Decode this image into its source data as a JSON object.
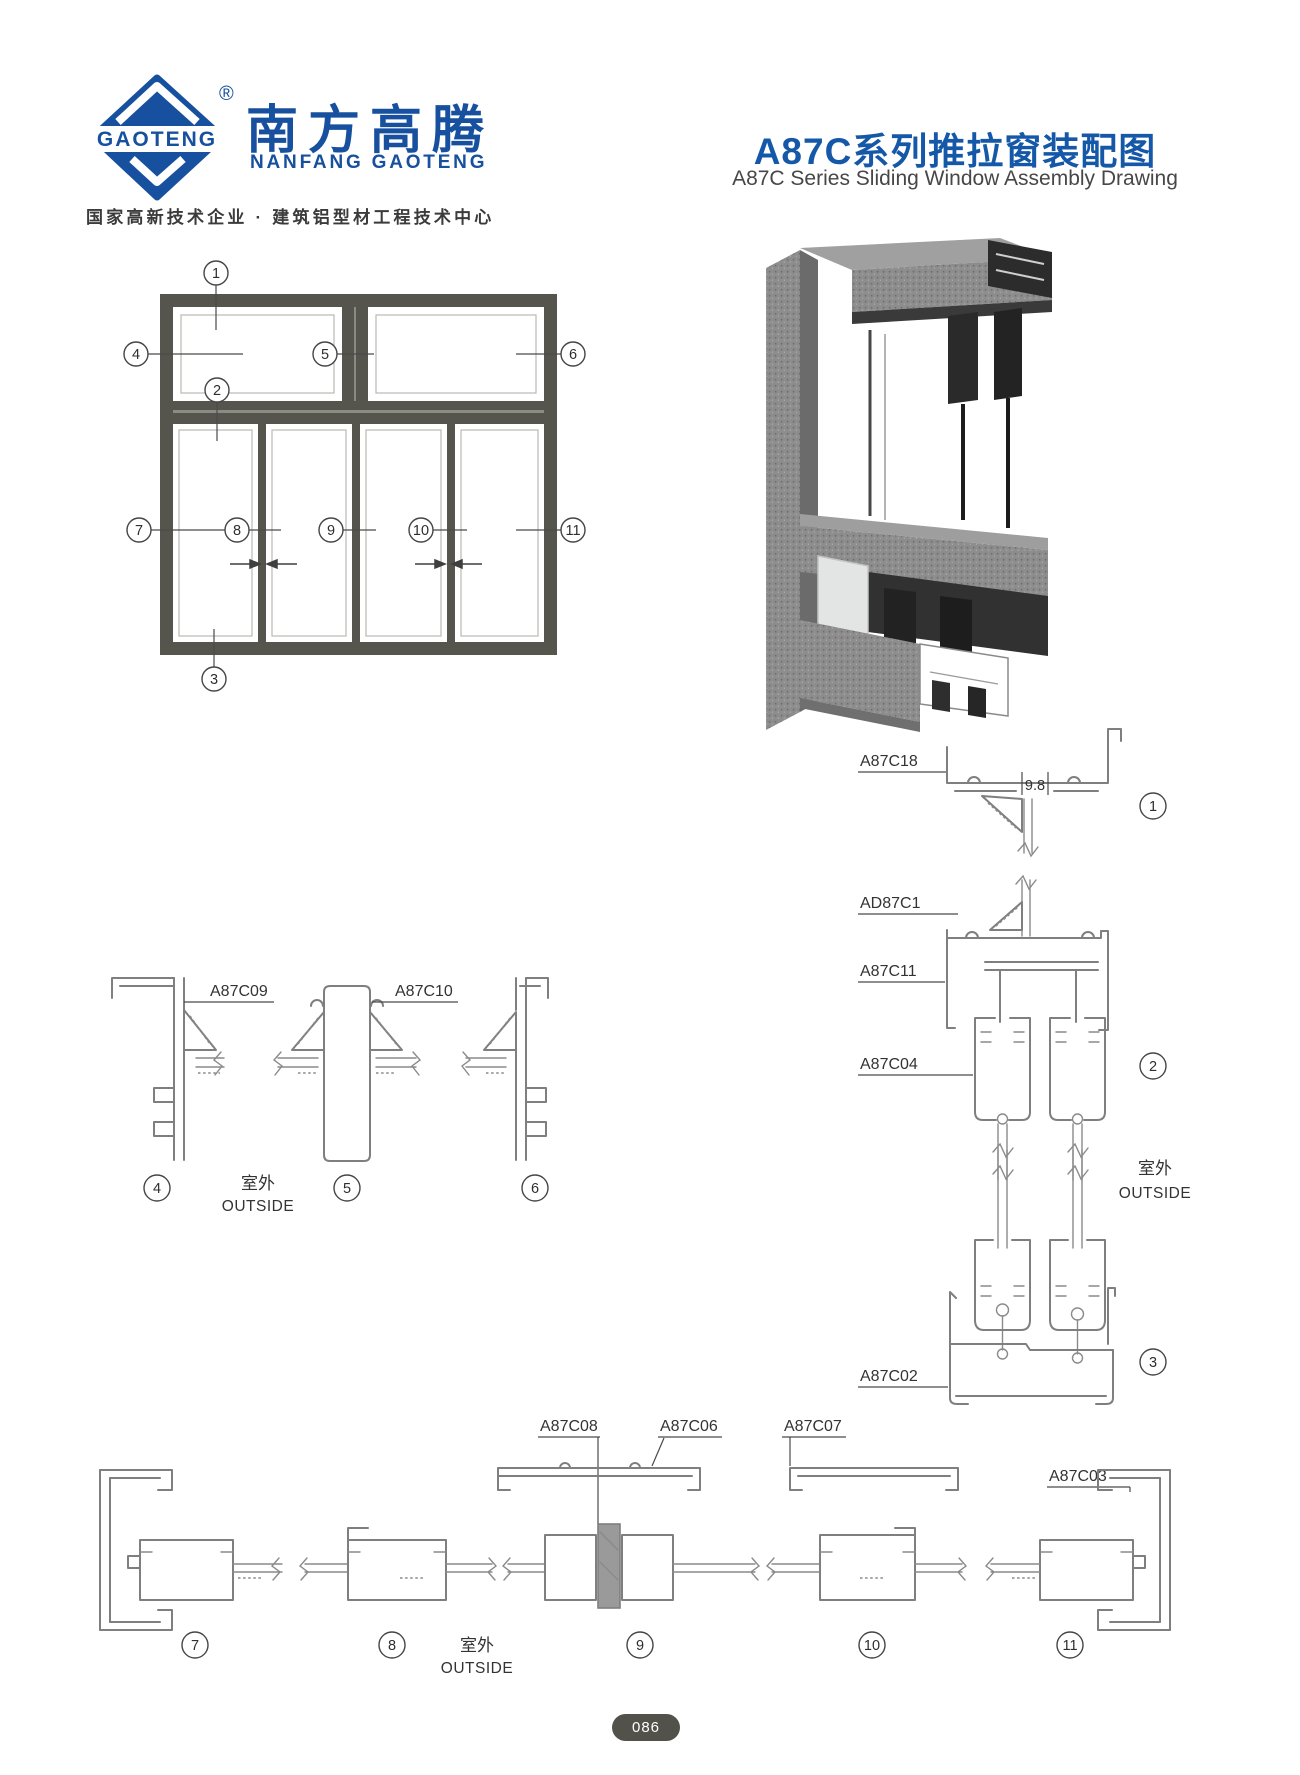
{
  "brand": {
    "logo_text": "GAOTENG",
    "registered": "®",
    "name_cn": "南方高腾",
    "name_en": "NANFANG GAOTENG",
    "tagline": "国家高新技术企业 · 建筑铝型材工程技术中心"
  },
  "title": {
    "cn": "A87C系列推拉窗装配图",
    "en": "A87C Series Sliding Window Assembly Drawing"
  },
  "callouts": {
    "c1": "1",
    "c2": "2",
    "c3": "3",
    "c4": "4",
    "c5": "5",
    "c6": "6",
    "c7": "7",
    "c8": "8",
    "c9": "9",
    "c10": "10",
    "c11": "11"
  },
  "labels": {
    "a87c18": "A87C18",
    "ad87c1": "AD87C1",
    "a87c11": "A87C11",
    "a87c04": "A87C04",
    "a87c02": "A87C02",
    "a87c09": "A87C09",
    "a87c10": "A87C10",
    "a87c08": "A87C08",
    "a87c06": "A87C06",
    "a87c07": "A87C07",
    "a87c03": "A87C03"
  },
  "dims": {
    "gap": "9.8"
  },
  "outside": {
    "cn": "室外",
    "en": "OUTSIDE"
  },
  "page": {
    "number": "086"
  },
  "colors": {
    "brand_blue": "#17509e",
    "title_blue": "#1658a8",
    "frame_gray": "#55554d",
    "line_gray": "#7f7f7f",
    "badge_bg": "#52524b"
  }
}
